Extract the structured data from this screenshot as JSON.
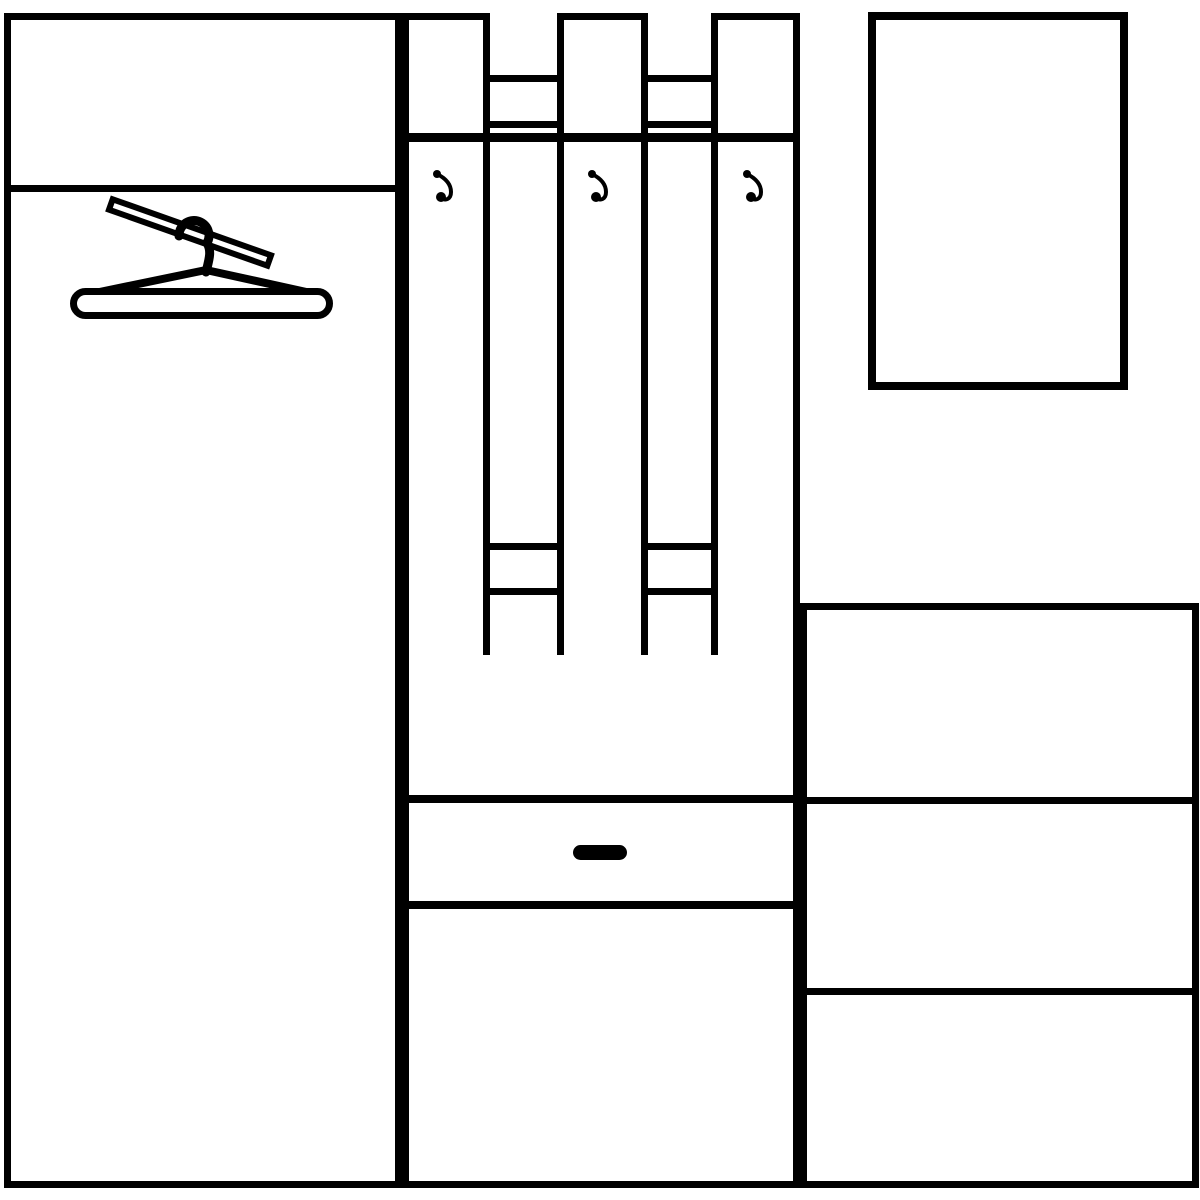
{
  "canvas": {
    "width": 1200,
    "height": 1200,
    "background_color": "#ffffff",
    "line_color": "#000000"
  },
  "diagram": {
    "kind": "hallway-furniture-set-line-drawing",
    "text_content": "none"
  },
  "components": [
    {
      "name": "wardrobe-cabinet",
      "type": "frame",
      "x": 4,
      "y": 13,
      "w": 398,
      "h": 1175,
      "border": [
        7,
        7,
        7,
        7
      ]
    },
    {
      "name": "wardrobe-shelf-divider",
      "type": "bar",
      "x": 11,
      "y": 185,
      "w": 384,
      "h": 7
    },
    {
      "name": "coat-panel-left",
      "type": "frame",
      "x": 402,
      "y": 13,
      "w": 88,
      "h": 649,
      "border": [
        7,
        7,
        7,
        7
      ]
    },
    {
      "name": "coat-panel-center",
      "type": "frame",
      "x": 557,
      "y": 13,
      "w": 91,
      "h": 649,
      "border": [
        7,
        7,
        7,
        7
      ]
    },
    {
      "name": "coat-panel-right",
      "type": "frame",
      "x": 711,
      "y": 13,
      "w": 89,
      "h": 649,
      "border": [
        7,
        7,
        7,
        7
      ]
    },
    {
      "name": "rail-top-left",
      "type": "frame",
      "x": 490,
      "y": 75,
      "w": 67,
      "h": 53,
      "border": [
        7,
        0,
        7,
        0
      ]
    },
    {
      "name": "rail-top-right",
      "type": "frame",
      "x": 648,
      "y": 75,
      "w": 63,
      "h": 53,
      "border": [
        7,
        0,
        7,
        0
      ]
    },
    {
      "name": "hat-shelf-edge",
      "type": "bar",
      "x": 402,
      "y": 133,
      "w": 398,
      "h": 9
    },
    {
      "name": "rail-bottom-left",
      "type": "frame",
      "x": 490,
      "y": 543,
      "w": 67,
      "h": 52,
      "border": [
        7,
        0,
        7,
        0
      ]
    },
    {
      "name": "rail-bottom-right",
      "type": "frame",
      "x": 648,
      "y": 543,
      "w": 63,
      "h": 52,
      "border": [
        7,
        0,
        7,
        0
      ]
    },
    {
      "name": "bench-cabinet",
      "type": "frame",
      "x": 402,
      "y": 655,
      "w": 398,
      "h": 533,
      "border": [
        0,
        7,
        7,
        7
      ]
    },
    {
      "name": "bench-seat-divider",
      "type": "bar",
      "x": 409,
      "y": 795,
      "w": 384,
      "h": 8
    },
    {
      "name": "drawer-bottom-divider",
      "type": "bar",
      "x": 409,
      "y": 901,
      "w": 384,
      "h": 8
    },
    {
      "name": "drawer-handle",
      "type": "bar",
      "x": 573,
      "y": 845,
      "w": 54,
      "h": 15,
      "radius": 8
    },
    {
      "name": "mirror-frame",
      "type": "frame",
      "x": 868,
      "y": 12,
      "w": 260,
      "h": 378,
      "border": [
        8,
        8,
        8,
        8
      ]
    },
    {
      "name": "shoe-cabinet",
      "type": "frame",
      "x": 800,
      "y": 603,
      "w": 399,
      "h": 585,
      "border": [
        7,
        7,
        7,
        7
      ]
    },
    {
      "name": "cabinet-divider-upper",
      "type": "bar",
      "x": 807,
      "y": 797,
      "w": 385,
      "h": 7
    },
    {
      "name": "cabinet-divider-lower",
      "type": "bar",
      "x": 807,
      "y": 988,
      "w": 385,
      "h": 7
    }
  ],
  "icons": [
    {
      "name": "clothes-hanger-icon",
      "kind": "hanger",
      "x": 60,
      "y": 188,
      "w": 285,
      "h": 142
    },
    {
      "name": "coat-hook-icon",
      "kind": "hook",
      "x": 428,
      "y": 166,
      "w": 34,
      "h": 44
    },
    {
      "name": "coat-hook-icon",
      "kind": "hook",
      "x": 583,
      "y": 166,
      "w": 34,
      "h": 44
    },
    {
      "name": "coat-hook-icon",
      "kind": "hook",
      "x": 738,
      "y": 166,
      "w": 34,
      "h": 44
    }
  ]
}
